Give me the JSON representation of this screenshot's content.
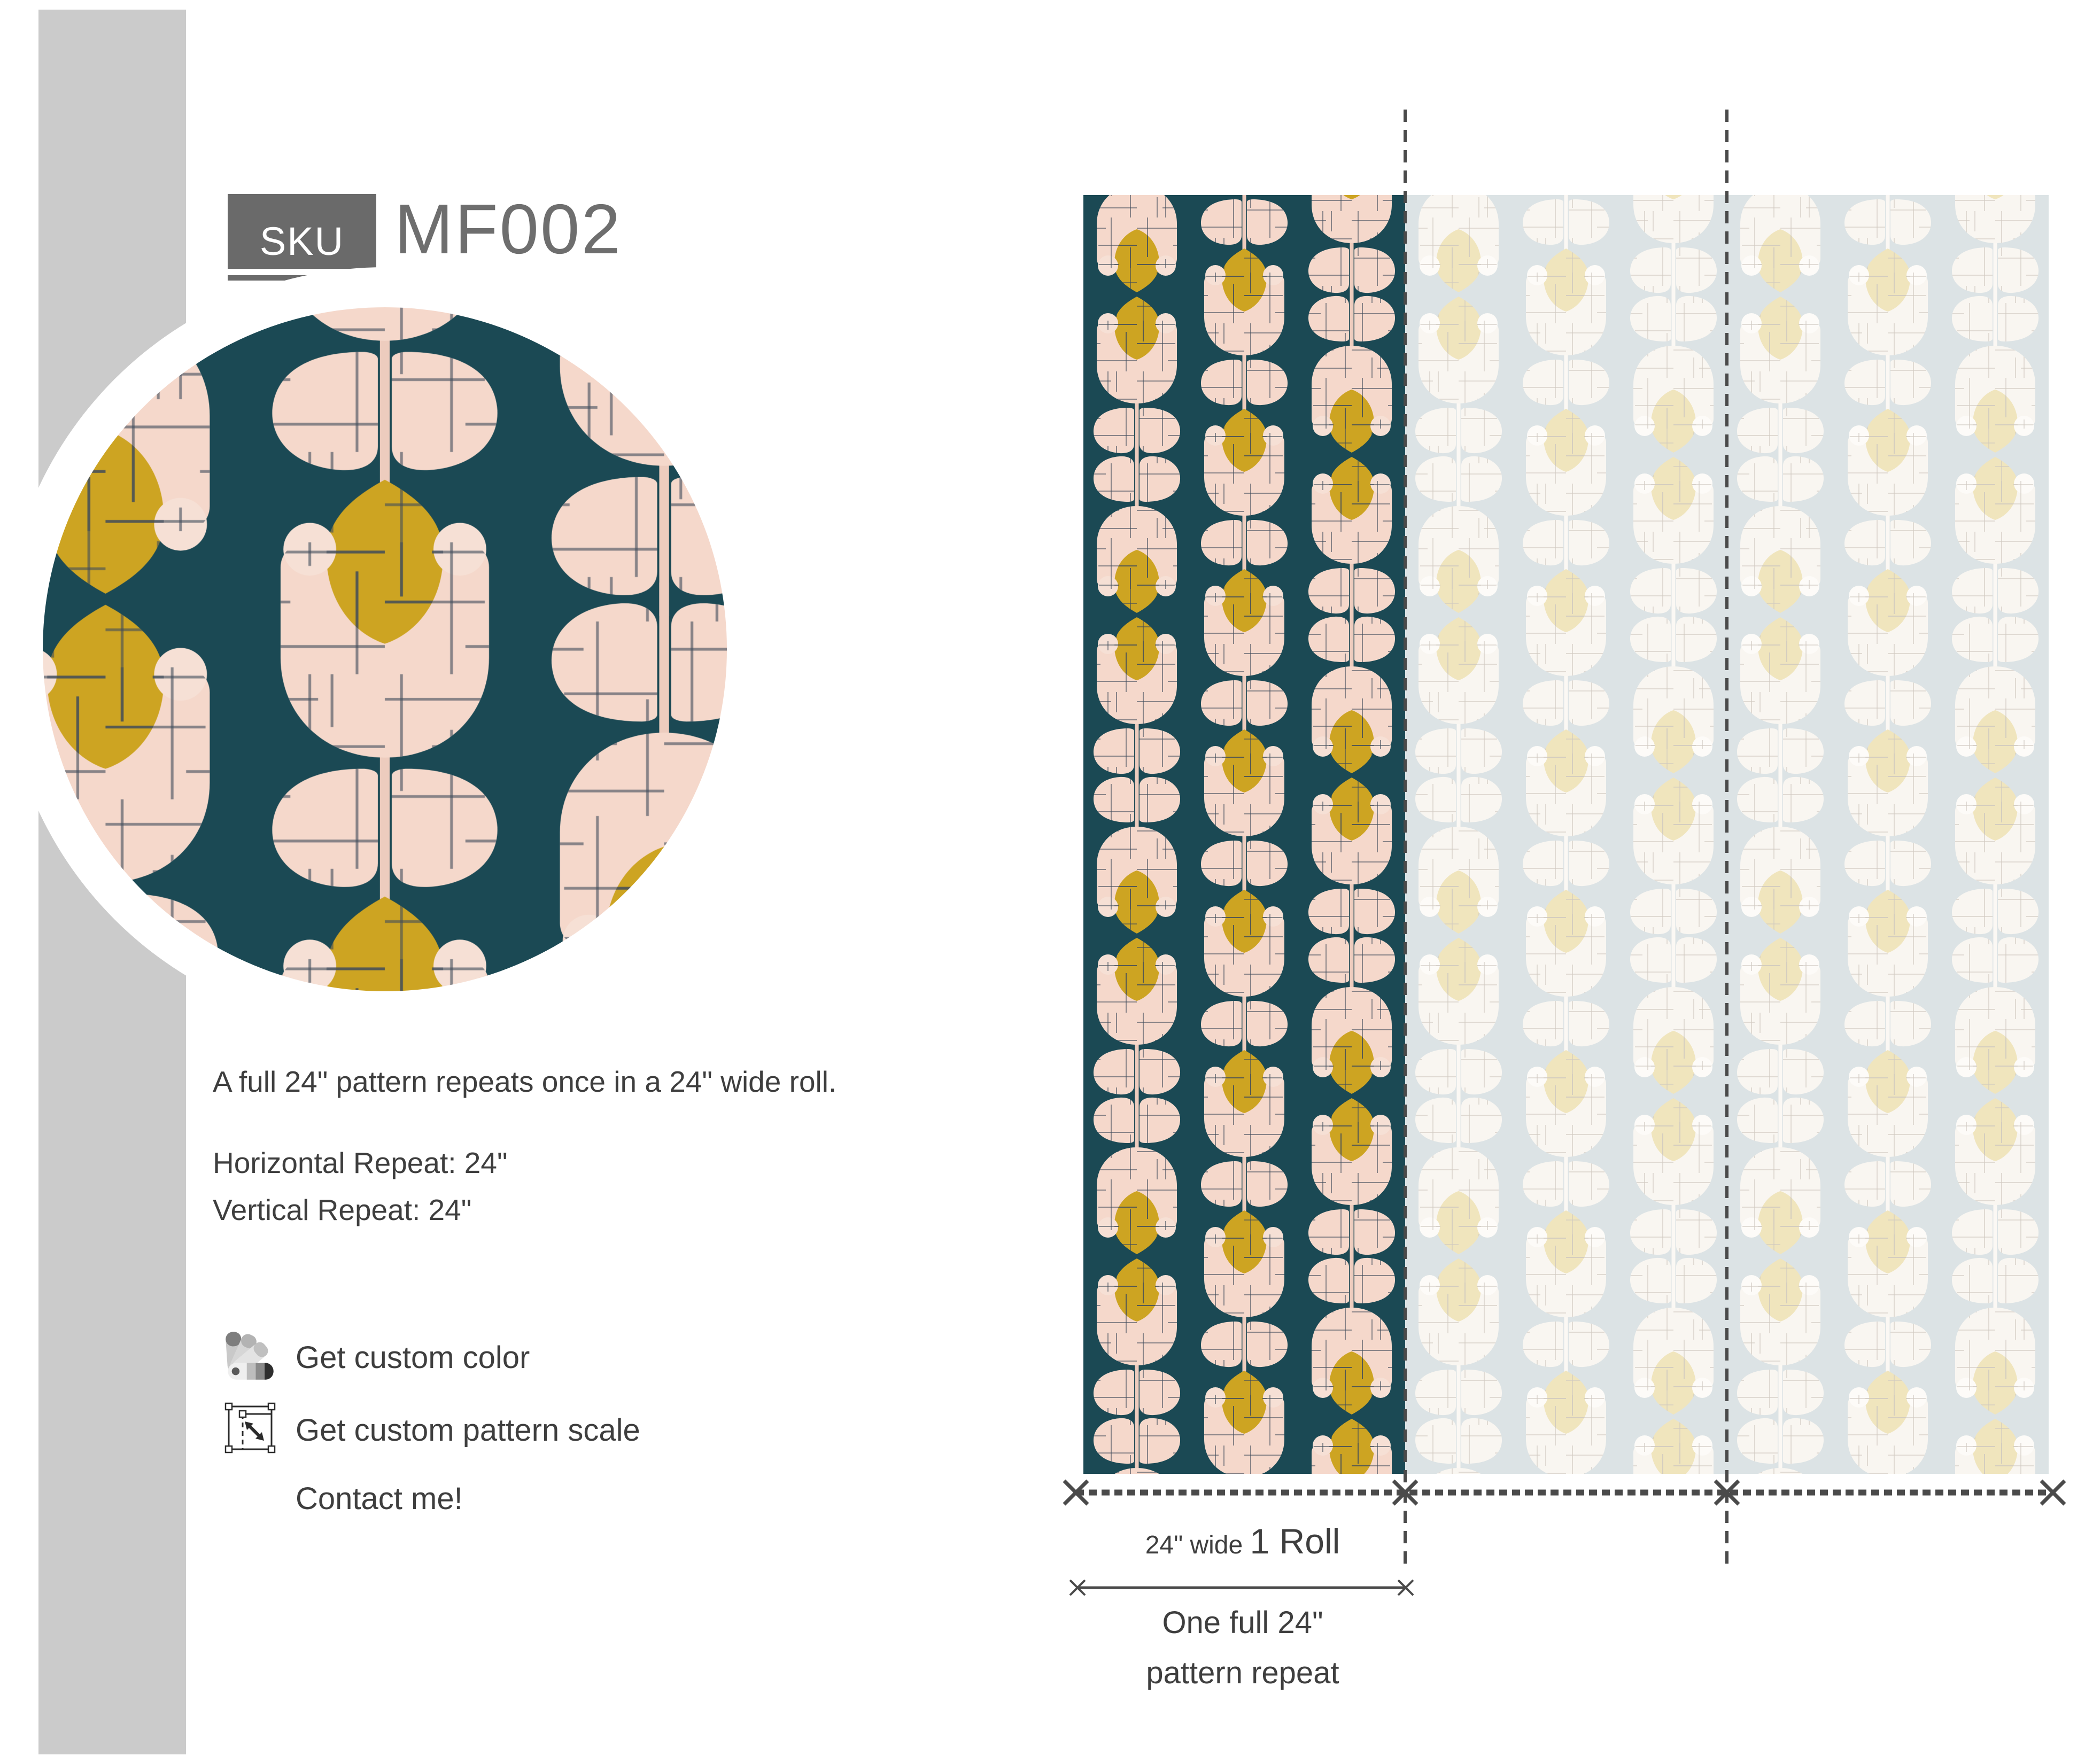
{
  "sku": {
    "label": "SKU",
    "value": "MF002"
  },
  "description": "A full 24\" pattern repeats once in a 24\" wide roll.",
  "repeats": {
    "horizontal": "Horizontal Repeat: 24\"",
    "vertical": "Vertical Repeat: 24\""
  },
  "actions": {
    "custom_color": "Get custom color",
    "custom_scale": "Get custom pattern scale",
    "contact": "Contact me!"
  },
  "roll_labels": {
    "width_prefix": "24\" wide ",
    "roll": "1 Roll",
    "repeat_line1": "One full 24\"",
    "repeat_line2": "pattern repeat"
  },
  "icons": [
    "color-fan-icon",
    "scale-pattern-icon"
  ],
  "colors": {
    "dark": {
      "bg": "#1b4954",
      "petal": "#f5d8cb",
      "mustard": "#cda422",
      "dot": "#f6e0d5",
      "stem": "#edccbe",
      "hatch": "#3e4a5a"
    },
    "faded": {
      "bg": "#dce3e5",
      "petal": "#f9f6f1",
      "mustard": "#f0e5bd",
      "dot": "#fdfbf8",
      "stem": "#fbf8f4",
      "hatch": "#cfc8bf"
    },
    "ui": {
      "bar": "#cbcbcb",
      "badge": "#6a6a6a",
      "dark": "#3e3e3e",
      "mid": "#6e6e6e",
      "line": "#4a4a4a"
    }
  }
}
